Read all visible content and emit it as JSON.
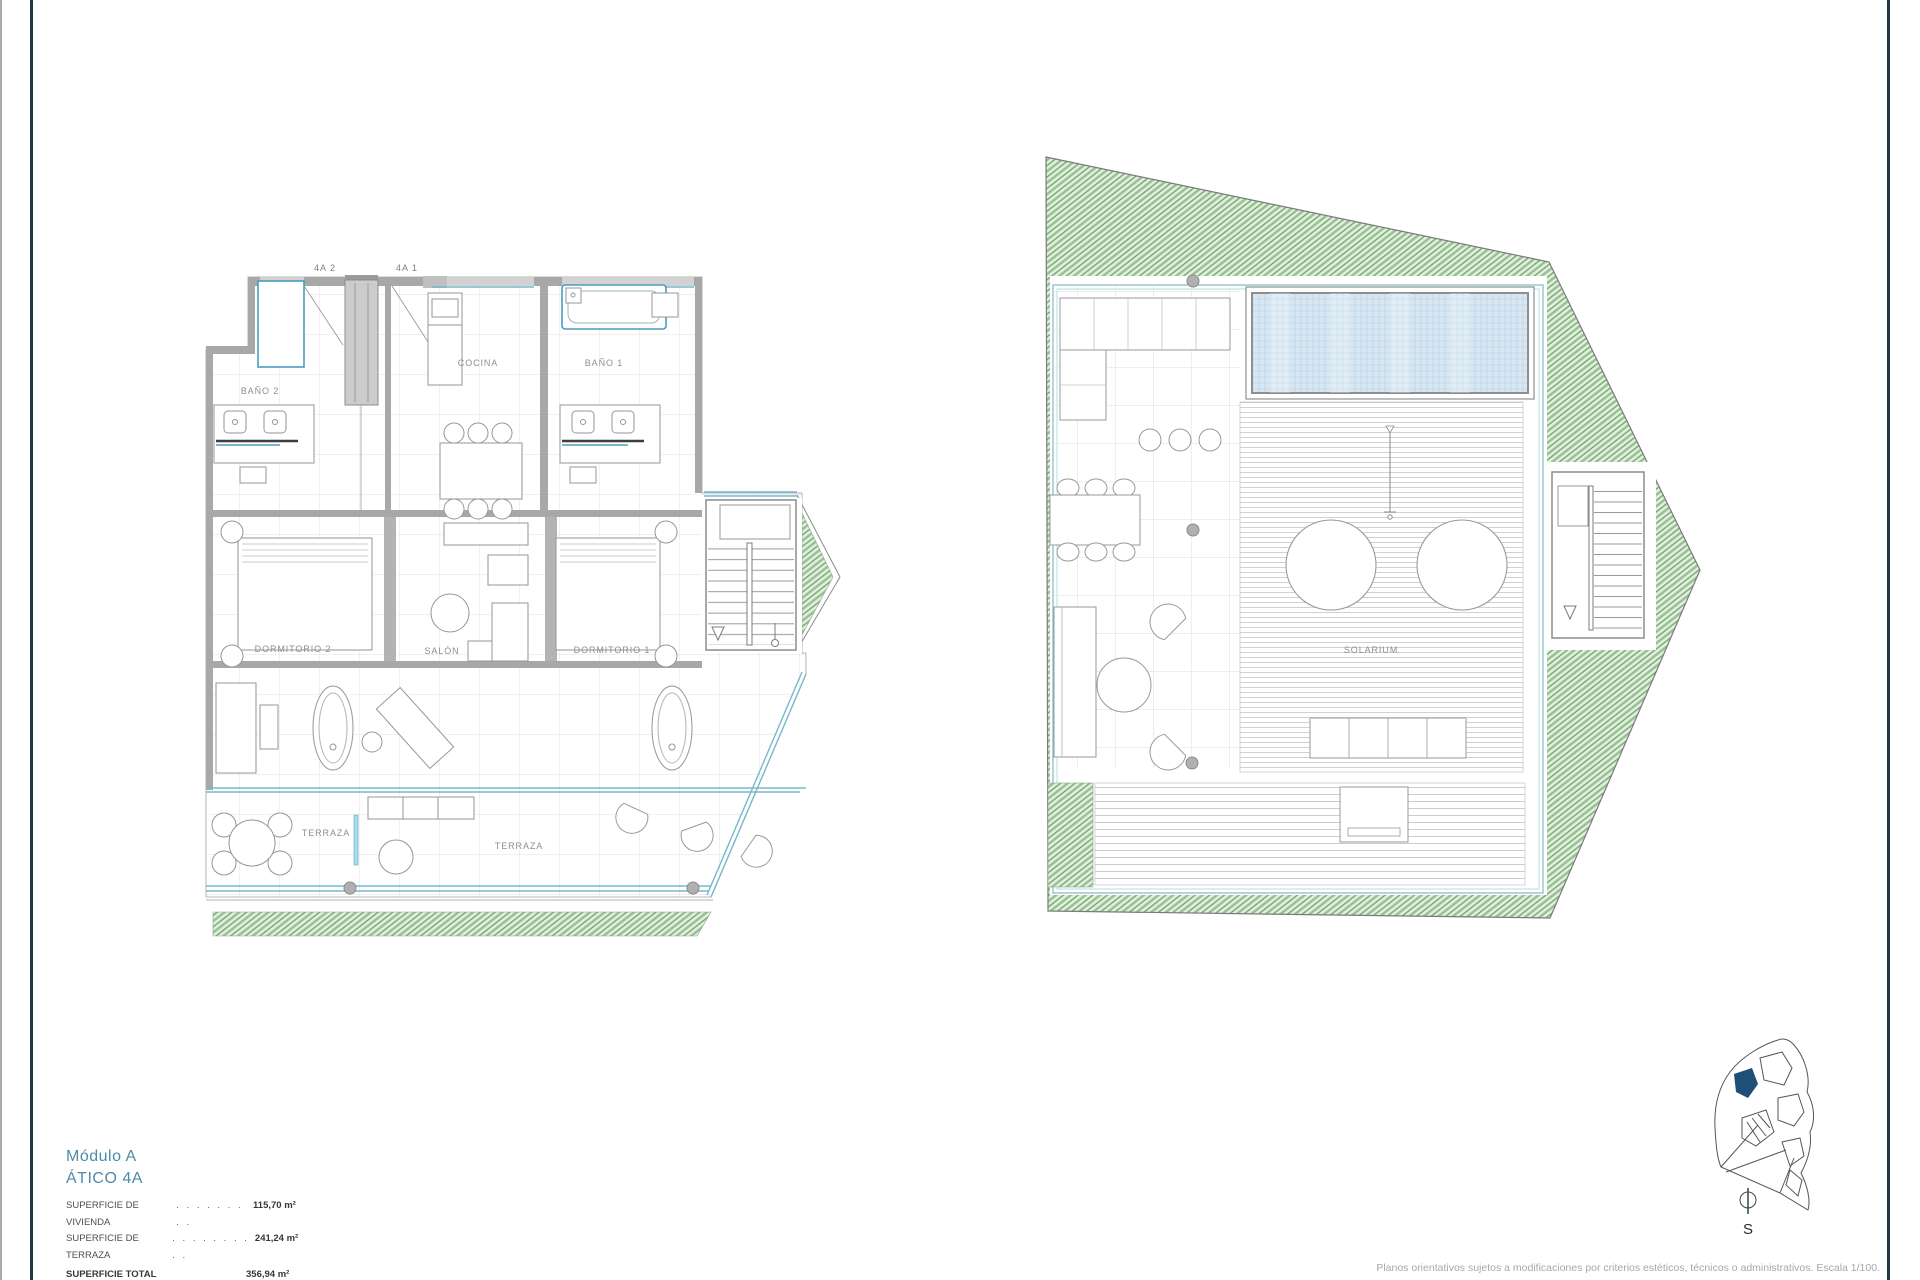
{
  "page": {
    "sheet_type": "floor-plan-sheet"
  },
  "title_block": {
    "module": "Módulo A",
    "unit": "ÁTICO 4A",
    "areas": [
      {
        "label": "SUPERFICIE DE VIVIENDA",
        "dots": ". . . . . . . . .",
        "value": "115,70 m²"
      },
      {
        "label": "SUPERFICIE DE TERRAZA",
        "dots": ". . . . . . . . . .",
        "value": "241,24 m²"
      },
      {
        "label": "SUPERFICIE TOTAL",
        "dots": "",
        "value": "356,94 m²"
      }
    ]
  },
  "apartment_plan": {
    "entries": {
      "left": "4A 2",
      "right": "4A 1"
    },
    "rooms": {
      "bath2": "BAÑO 2",
      "kitchen": "COCINA",
      "bath1": "BAÑO 1",
      "bedroom2": "DORMITORIO 2",
      "living": "SALÓN",
      "bedroom1": "DORMITORIO 1",
      "terrace_left": "TERRAZA",
      "terrace_right": "TERRAZA"
    }
  },
  "roof_plan": {
    "solarium": "SOLARIUM"
  },
  "site_plan": {
    "compass": "S"
  },
  "footer": {
    "disclaimer": "Planos orientativos sujetos a modificaciones por criterios estéticos, técnicos o administrativos. Escala 1/100."
  },
  "colors": {
    "accent_teal": "#4e8ba6",
    "rule_navy": "#1d3847",
    "glass_cyan": "#79b7cc",
    "green_landscape": "#8abc8a",
    "pool_blue": "#d7e7f3",
    "wall_gray": "#a8a8a8",
    "site_highlight": "#1f4e79"
  }
}
